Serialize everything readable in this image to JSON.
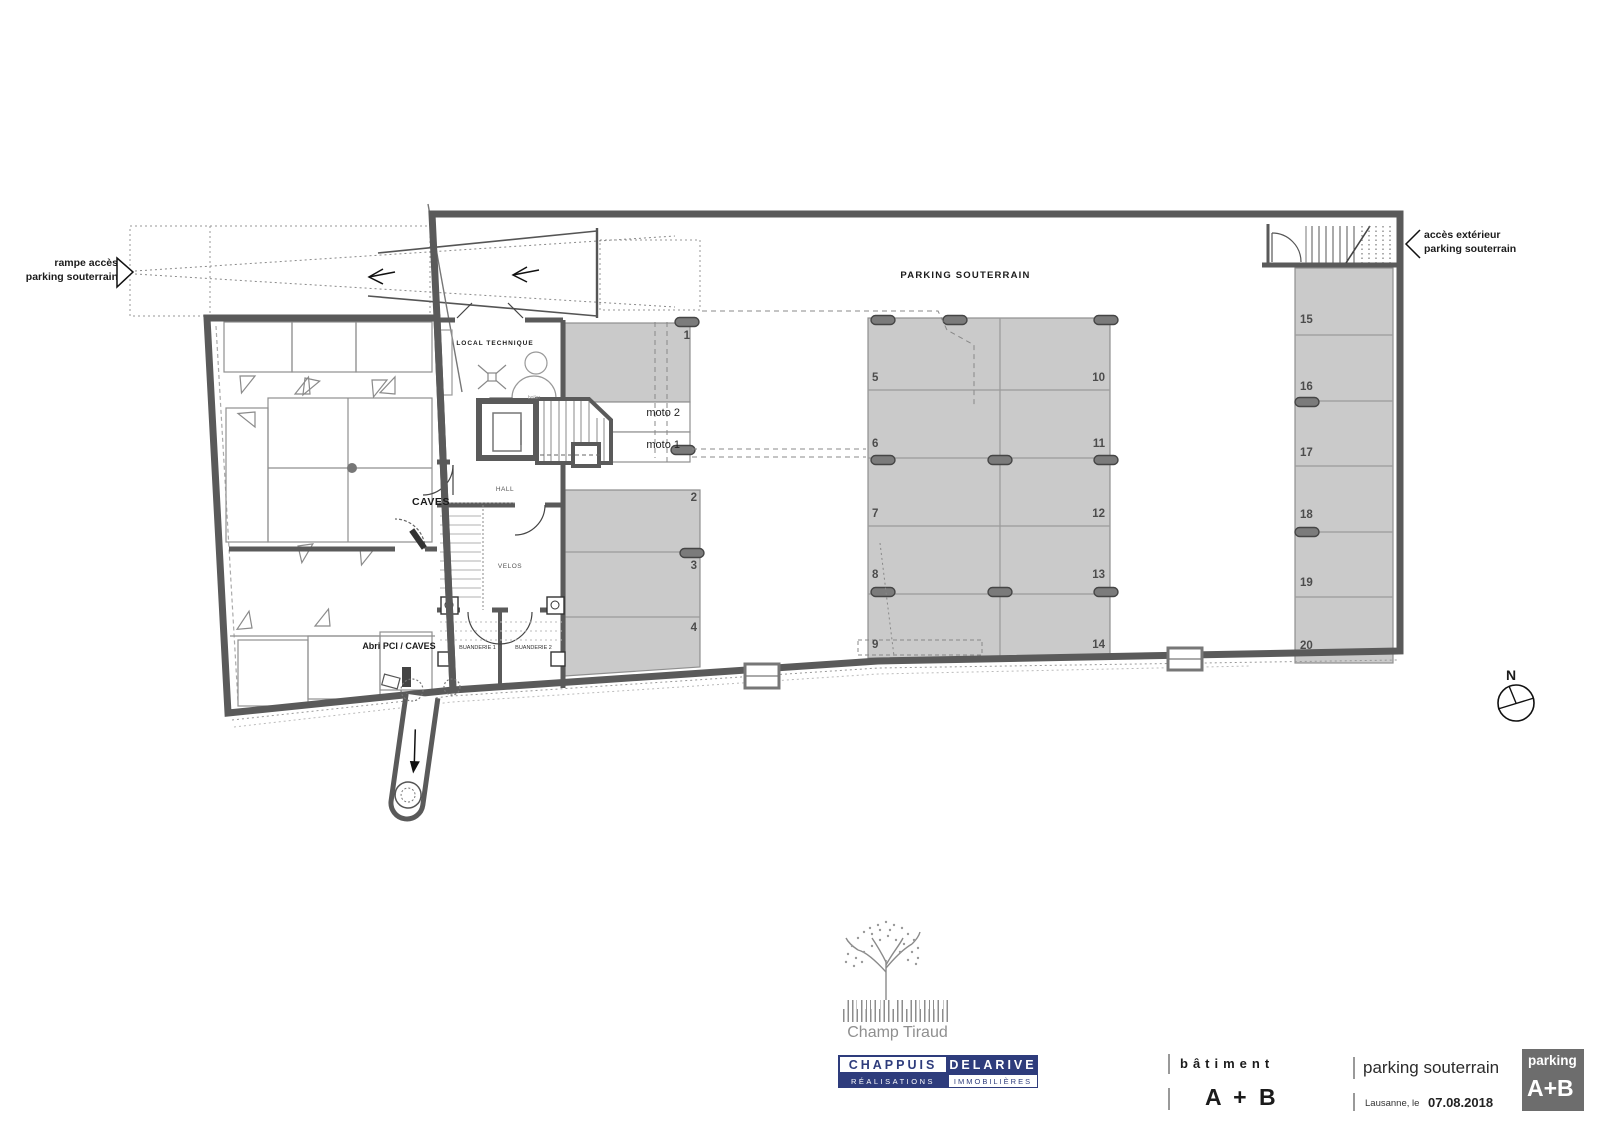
{
  "plan": {
    "title": "PARKING SOUTERRAIN",
    "ramp_label": {
      "line1": "rampe accès",
      "line2": "parking souterrain"
    },
    "exterior_access_label": {
      "line1": "accès extérieur",
      "line2": "parking souterrain"
    },
    "north_label": "N",
    "rooms": {
      "local_technique": "LOCAL TECHNIQUE",
      "boiler": "boiler",
      "caves": "CAVES",
      "hall": "HALL",
      "velos": "VELOS",
      "buanderie1": "BUANDERIE 1",
      "buanderie2": "BUANDERIE 2",
      "abri_pci": "Abri PCI / CAVES"
    },
    "moto_spots": {
      "moto1": "moto 1",
      "moto2": "moto 2"
    },
    "spot_numbers": [
      "1",
      "2",
      "3",
      "4",
      "5",
      "6",
      "7",
      "8",
      "9",
      "10",
      "11",
      "12",
      "13",
      "14",
      "15",
      "16",
      "17",
      "18",
      "19",
      "20"
    ]
  },
  "title_block": {
    "project_name": "Champ Tiraud",
    "company": {
      "row1_left": "CHAPPUIS",
      "row1_right": "DELARIVE",
      "row2_left": "RÉALISATIONS",
      "row2_right": "IMMOBILIÈRES"
    },
    "batiment_label": "bâtiment",
    "batiment_value": "A + B",
    "drawing_title": "parking souterrain",
    "place_label": "Lausanne, le",
    "date": "07.08.2018",
    "badge": {
      "top": "parking",
      "bottom": "A+B"
    }
  },
  "colors": {
    "navy": "#2e3c7c",
    "badge_gray": "#6d6d6d",
    "stall_gray": "#cacaca",
    "wall_gray": "#5a5a5a"
  }
}
